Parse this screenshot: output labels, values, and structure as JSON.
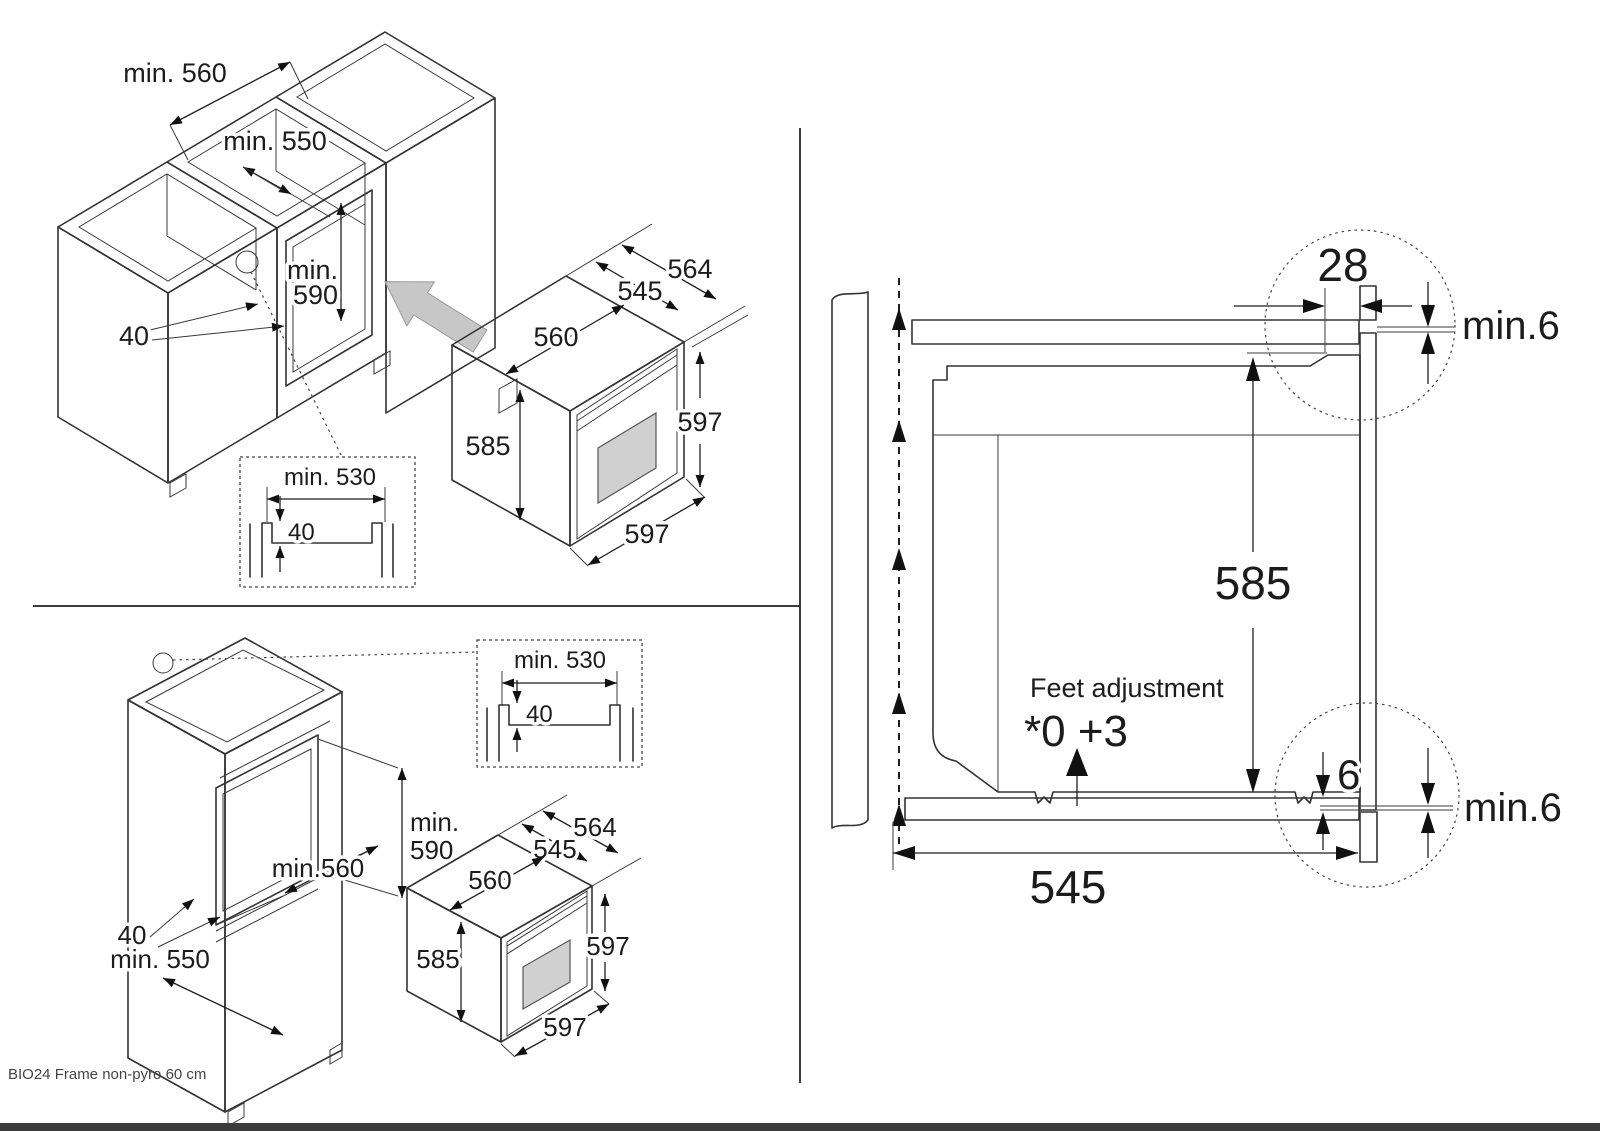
{
  "footer": "BIO24 Frame non-pyro 60 cm",
  "top_left": {
    "cabinet": {
      "min560": "min. 560",
      "min550": "min. 550",
      "min590_l1": "min.",
      "min590_l2": "590",
      "rail_40": "40"
    },
    "inset": {
      "min530": "min. 530",
      "notch_40": "40"
    },
    "oven": {
      "w564": "564",
      "d545": "545",
      "w560": "560",
      "h585": "585",
      "h597": "597",
      "w597": "597"
    }
  },
  "bottom_left": {
    "cabinet": {
      "min590_l1": "min.",
      "min590_l2": "590",
      "min560": "min.560",
      "rail_40": "40",
      "min550": "min. 550"
    },
    "inset": {
      "min530": "min. 530",
      "notch_40": "40"
    },
    "oven": {
      "w564": "564",
      "d545": "545",
      "w560": "560",
      "h585": "585",
      "h597": "597",
      "w597": "597"
    }
  },
  "right": {
    "top_overlap_28": "28",
    "gap_top": "min.6",
    "height_585": "585",
    "feet_label": "Feet adjustment",
    "feet_values": "*0 +3",
    "bottom_overlap_6": "6",
    "gap_bottom": "min.6",
    "depth_545": "545"
  },
  "colors": {
    "line": "#333333",
    "oven_body_gray": "#b3b3b3",
    "oven_face_gray": "#a6a6a6",
    "frame_gray": "#8e8e8e",
    "window_gray": "#d0d0d0",
    "arrow_gray": "#c7c7c7",
    "footer_text": "#444444"
  }
}
